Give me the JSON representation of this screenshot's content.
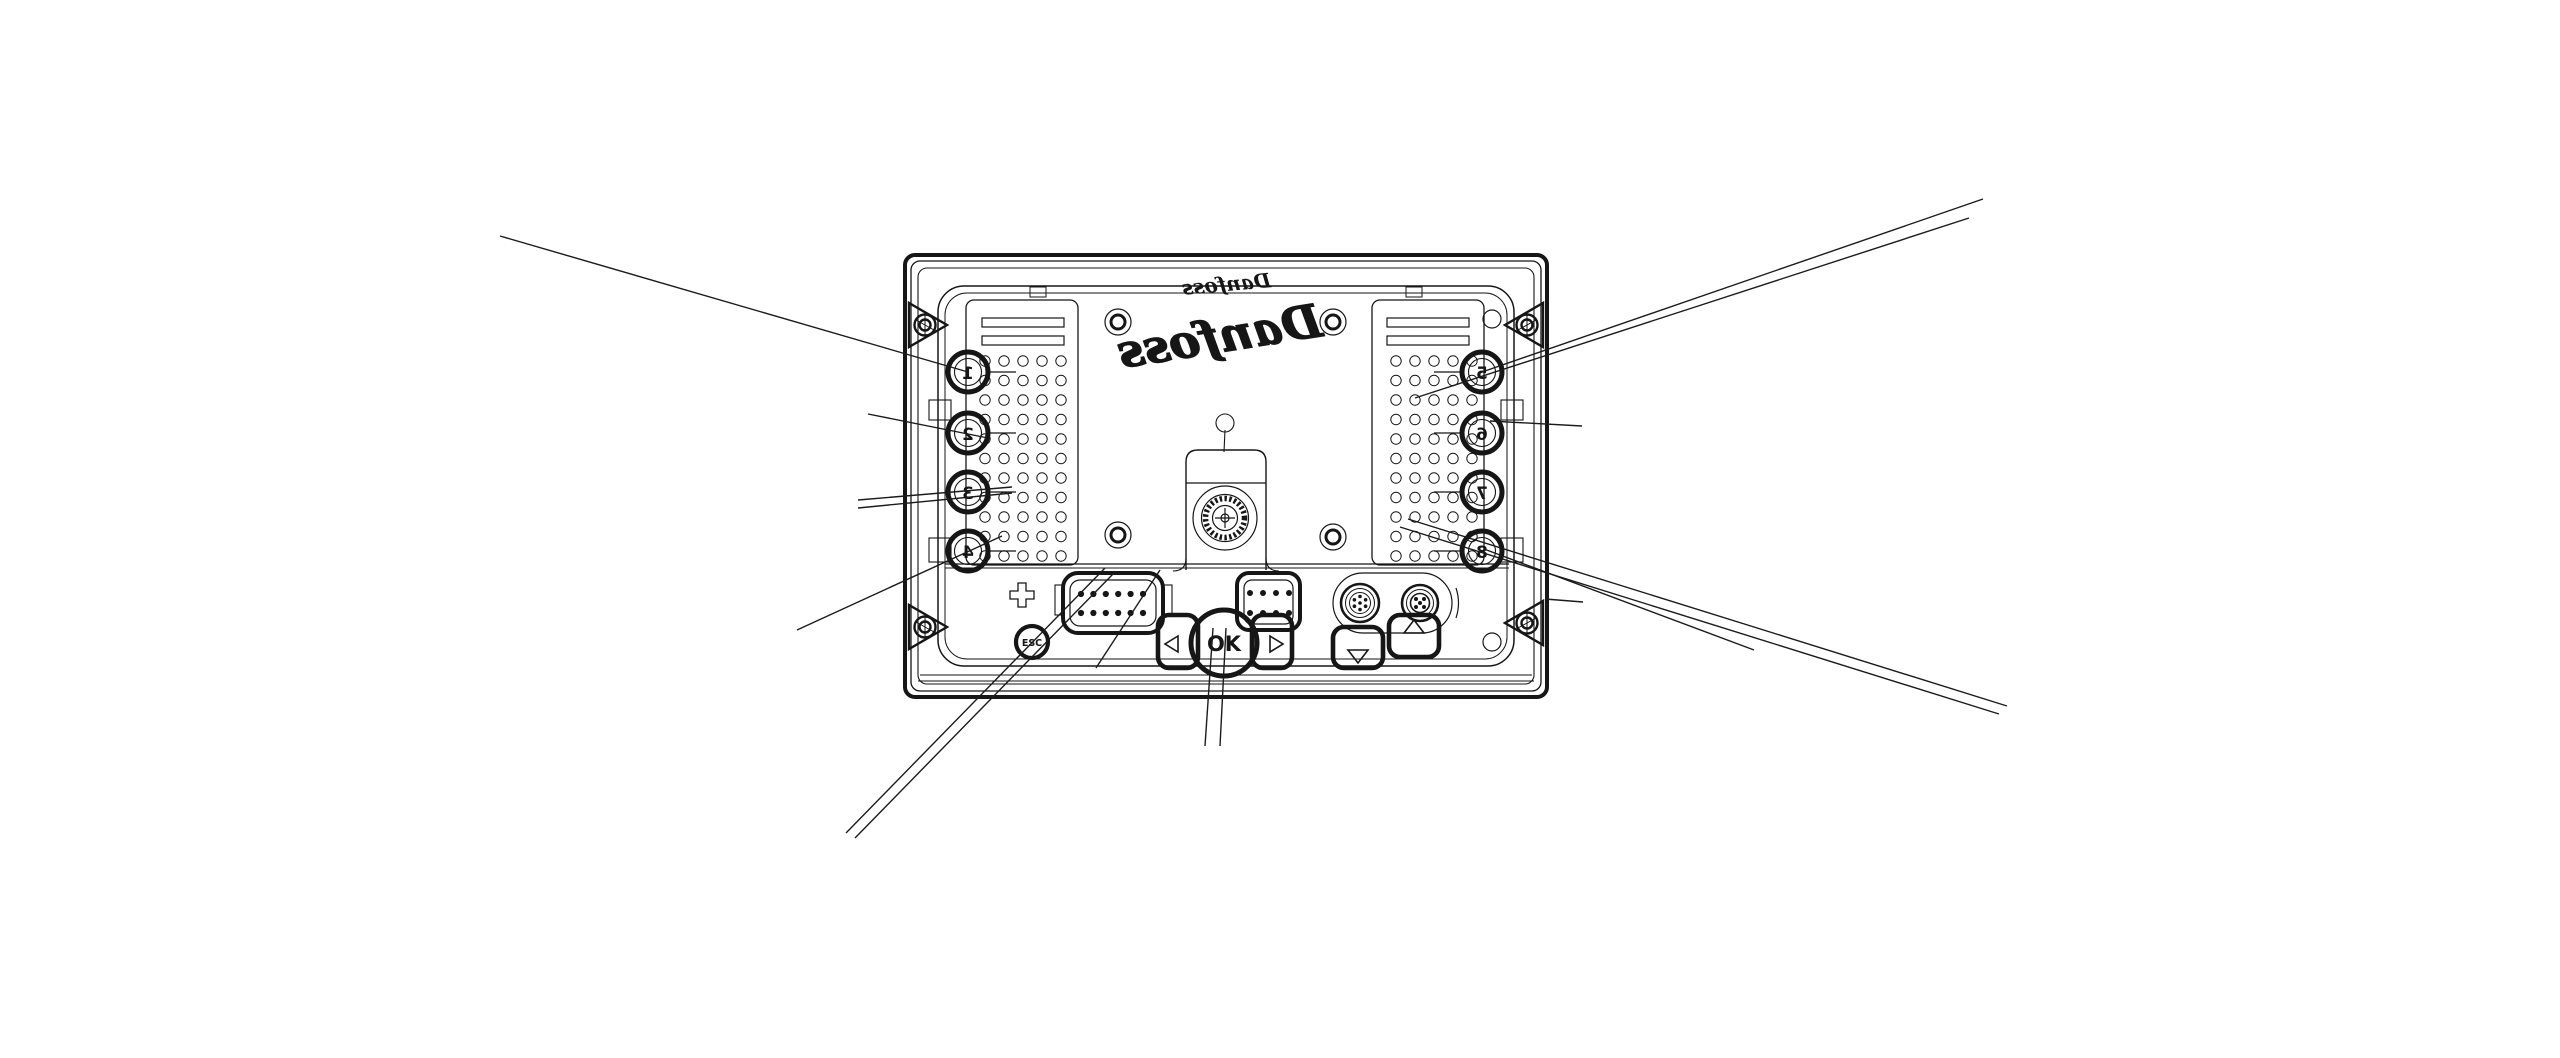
{
  "drawing": {
    "type": "technical-line-drawing",
    "subject": "display-unit-rear-view",
    "background": "#ffffff",
    "ink": "#161616",
    "brand_logo_top": "Danfoss",
    "brand_logo_center": "Danfoss",
    "keypad": {
      "left_keys": [
        "1",
        "2",
        "3",
        "4"
      ],
      "right_keys": [
        "5",
        "6",
        "7",
        "8"
      ],
      "esc_label": "ESC",
      "ok_label": "OK",
      "arrow_icons": [
        "left-arrow",
        "right-arrow",
        "up-arrow",
        "down-arrow"
      ]
    },
    "connectors": [
      "rect-12pin-connector",
      "rect-8pin-connector",
      "round-7pin-connector",
      "round-5pin-connector",
      "center-round-connector"
    ],
    "callout_leader_lines_count": 14
  }
}
